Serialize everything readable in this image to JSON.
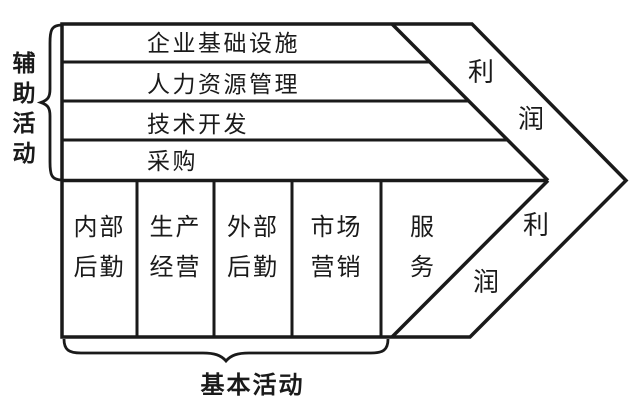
{
  "figure": {
    "type": "value-chain-arrow-diagram",
    "colors": {
      "line": "#1a1a1a",
      "background": "#ffffff",
      "text": "#1a1a1a"
    },
    "support": {
      "group_label": "辅助活动",
      "rows": [
        "企业基础设施",
        "人力资源管理",
        "技术开发",
        "采购"
      ]
    },
    "primary": {
      "group_label": "基本活动",
      "columns": [
        {
          "label": "内部后勤",
          "lines": [
            "内部",
            "后勤"
          ]
        },
        {
          "label": "生产经营",
          "lines": [
            "生产",
            "经营"
          ]
        },
        {
          "label": "外部后勤",
          "lines": [
            "外部",
            "后勤"
          ]
        },
        {
          "label": "市场营销",
          "lines": [
            "市场",
            "营销"
          ]
        },
        {
          "label": "服务",
          "lines": [
            "服",
            "务"
          ]
        }
      ]
    },
    "profit_top": {
      "label": "利润",
      "chars": [
        "利",
        "润"
      ]
    },
    "profit_bottom": {
      "label": "利润",
      "chars": [
        "利",
        "润"
      ]
    }
  }
}
